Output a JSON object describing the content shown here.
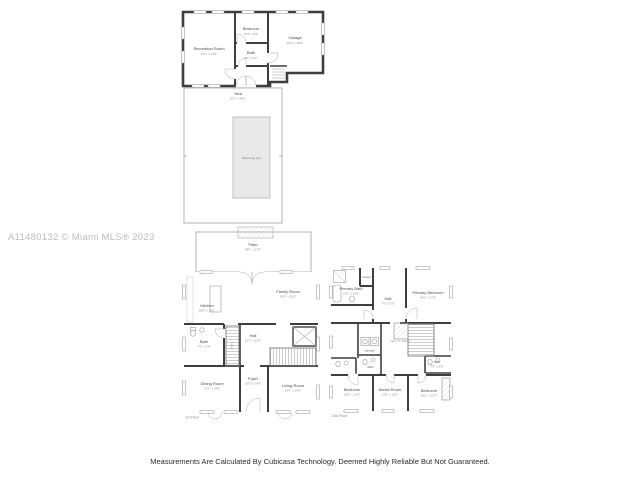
{
  "watermark": "A11480132 © Miami MLS® 2023",
  "disclaimer": "Measurements Are Calculated By Cubicasa Technology. Deemed Highly Reliable But Not Guaranteed.",
  "colors": {
    "wall": "#3e3e3e",
    "thin_wall": "#b3b3b3",
    "pool_fill": "#e9e9e9",
    "room_label": "#4a4a4a",
    "dims_label": "#8c8c8c",
    "watermark": "#bcbcbc"
  },
  "plans": {
    "guest_house": {
      "recreation_room": {
        "name": "Recreation Room",
        "dims": "15'0\" x 21'6\""
      },
      "bedroom": {
        "name": "Bedroom",
        "dims": "10'6\" x 9'6\""
      },
      "bath": {
        "name": "Bath",
        "dims": "6'0\" x 5'0\""
      },
      "garage": {
        "name": "Garage",
        "dims": "20'6\" x 20'0\""
      }
    },
    "yard": {
      "name": "Yard",
      "dims": "32'0\" x 45'0\"",
      "pool": "Swimming pool"
    },
    "floor1": {
      "label": "1st Floor",
      "patio": {
        "name": "Patio",
        "dims": "38'0\" x 12'6\""
      },
      "kitchen": {
        "name": "Kitchen",
        "dims": "18'6\" x 13'0\""
      },
      "family_room": {
        "name": "Family Room",
        "dims": "24'6\" x 15'6\""
      },
      "bath": {
        "name": "Bath",
        "dims": "7'0\" x 5'6\""
      },
      "stairs": {
        "name": "Stairs"
      },
      "hall": {
        "name": "Hall",
        "dims": "10'0\" x 12'0\""
      },
      "dining_room": {
        "name": "Dining Room",
        "dims": "17'6\" x 14'0\""
      },
      "foyer": {
        "name": "Foyer",
        "dims": "10'0\" x 14'0\""
      },
      "living_room": {
        "name": "Living Room",
        "dims": "15'0\" x 14'0\""
      }
    },
    "floor2": {
      "label": "2nd Floor",
      "primary_bath": {
        "name": "Primary Bath",
        "dims": "13'0\" x 10'6\""
      },
      "closet": {
        "name": "Closet"
      },
      "hall": {
        "name": "Hall",
        "dims": "7'6\" x 5'0\""
      },
      "primary_bedroom": {
        "name": "Primary Bedroom",
        "dims": "14'6\" x 17'0\""
      },
      "laundry": {
        "name": "Laundry"
      },
      "bath_center": {
        "name": "Bath"
      },
      "open_to_below": {
        "name": "Open To Below"
      },
      "bath_right": {
        "name": "Bath",
        "dims": "7'6\" x 5'0\""
      },
      "bedroom_left": {
        "name": "Bedroom",
        "dims": "13'6\" x 12'0\""
      },
      "media_room": {
        "name": "Media Room",
        "dims": "11'6\" x 12'0\""
      },
      "bedroom_right": {
        "name": "Bedroom",
        "dims": "14'0\" x 12'0\""
      }
    }
  }
}
